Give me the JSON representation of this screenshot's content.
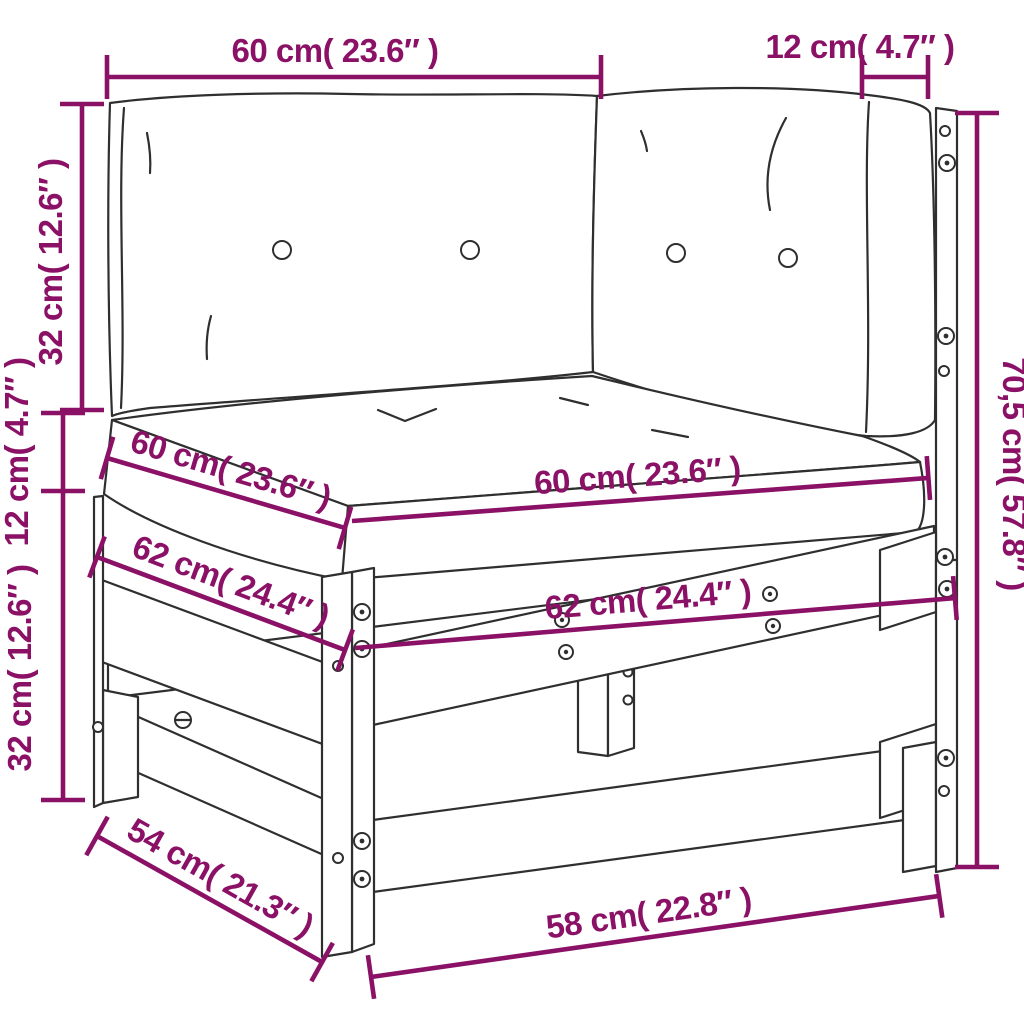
{
  "figure": {
    "type": "furniture-dimension-diagram",
    "subject": "corner garden sofa section with back cushions and seat cushion on a wooden slat frame",
    "background_color": "#ffffff",
    "dimension_color": "#8a1166",
    "outline_color": "#2f2f2f"
  },
  "dims": {
    "back_width": {
      "label": "60 cm( 23.6″ )",
      "cm": "60",
      "inches": "23.6"
    },
    "side_width": {
      "label": "12 cm( 4.7″ )",
      "cm": "12",
      "inches": "4.7"
    },
    "back_cushion_height": {
      "label": "32 cm( 12.6″ )",
      "cm": "32",
      "inches": "12.6"
    },
    "seat_cushion_thickness": {
      "label": "12 cm( 4.7″ )",
      "cm": "12",
      "inches": "4.7"
    },
    "frame_height": {
      "label": "32 cm( 12.6″ )",
      "cm": "32",
      "inches": "12.6"
    },
    "total_height": {
      "label": "70,5 cm( 57.8″ )",
      "cm": "70,5",
      "inches": "57.8"
    },
    "seat_depth": {
      "label": "60 cm( 23.6″ )",
      "cm": "60",
      "inches": "23.6"
    },
    "seat_width": {
      "label": "60 cm( 23.6″ )",
      "cm": "60",
      "inches": "23.6"
    },
    "frame_depth": {
      "label": "62 cm( 24.4″ )",
      "cm": "62",
      "inches": "24.4"
    },
    "frame_width": {
      "label": "62 cm( 24.4″ )",
      "cm": "62",
      "inches": "24.4"
    },
    "base_depth": {
      "label": "54 cm( 21.3″ )",
      "cm": "54",
      "inches": "21.3"
    },
    "base_width": {
      "label": "58 cm( 22.8″ )",
      "cm": "58",
      "inches": "22.8"
    }
  }
}
